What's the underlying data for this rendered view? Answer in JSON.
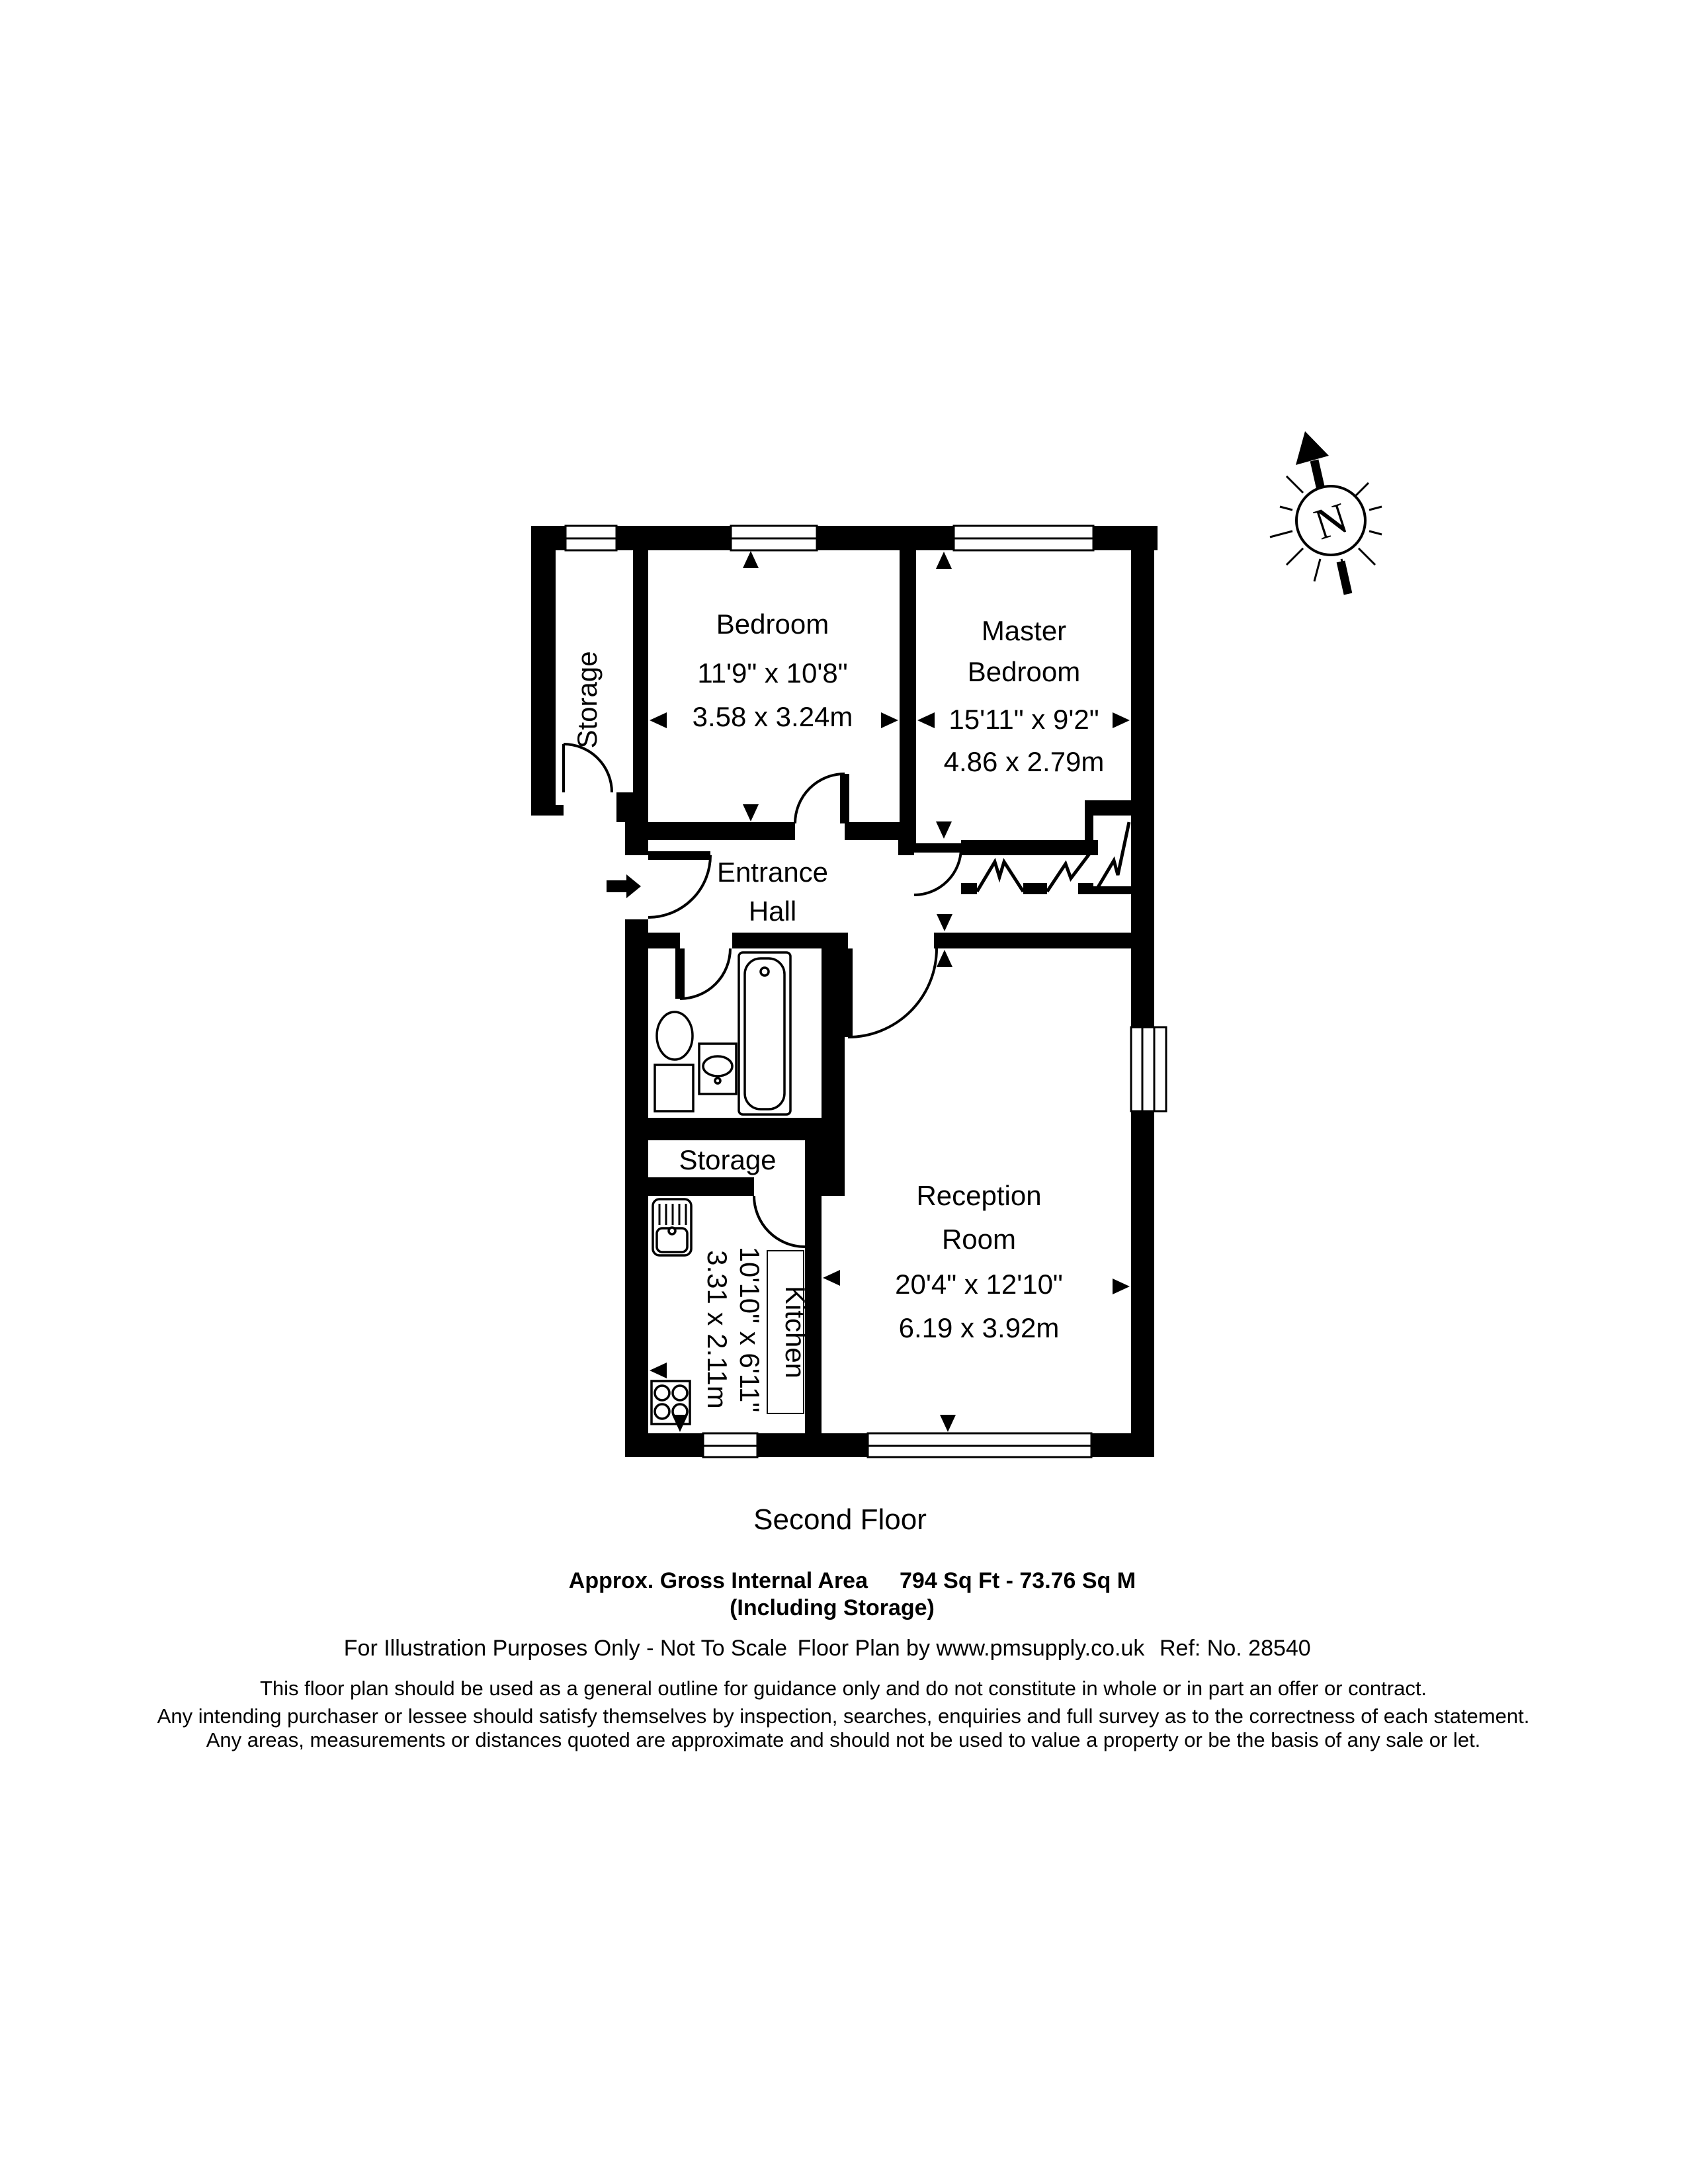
{
  "floorplan": {
    "compass": {
      "label": "N"
    },
    "rooms": {
      "storage_top": {
        "name": "Storage"
      },
      "bedroom": {
        "name": "Bedroom",
        "dims_imperial": "11'9\" x 10'8\"",
        "dims_metric": "3.58 x 3.24m"
      },
      "master_bedroom": {
        "name_line1": "Master",
        "name_line2": "Bedroom",
        "dims_imperial": "15'11\" x 9'2\"",
        "dims_metric": "4.86 x 2.79m"
      },
      "entrance_hall": {
        "name_line1": "Entrance",
        "name_line2": "Hall"
      },
      "storage_lower": {
        "name": "Storage"
      },
      "kitchen": {
        "name": "Kitchen",
        "dims_imperial": "10'10\" x 6'11\"",
        "dims_metric": "3.31 x 2.11m"
      },
      "reception": {
        "name_line1": "Reception",
        "name_line2": "Room",
        "dims_imperial": "20'4\" x 12'10\"",
        "dims_metric": "6.19 x 3.92m"
      }
    }
  },
  "caption": {
    "floor": "Second Floor",
    "area_label": "Approx. Gross Internal Area",
    "area_value": "794 Sq Ft - 73.76 Sq M",
    "area_note": "(Including Storage)",
    "illustration_note": "For Illustration Purposes Only - Not To Scale",
    "credit": "Floor Plan by www.pmsupply.co.uk",
    "reference": "Ref: No. 28540",
    "disclaimer_line1": "This floor plan should be used as a general outline for guidance only and do not constitute in whole or in part an offer or contract.",
    "disclaimer_line2": "Any intending purchaser or lessee should satisfy themselves by inspection, searches, enquiries and full survey as to the correctness of each statement.",
    "disclaimer_line3": "Any areas, measurements or distances quoted are approximate and should not be used to value a property or be the basis of any sale or let."
  }
}
